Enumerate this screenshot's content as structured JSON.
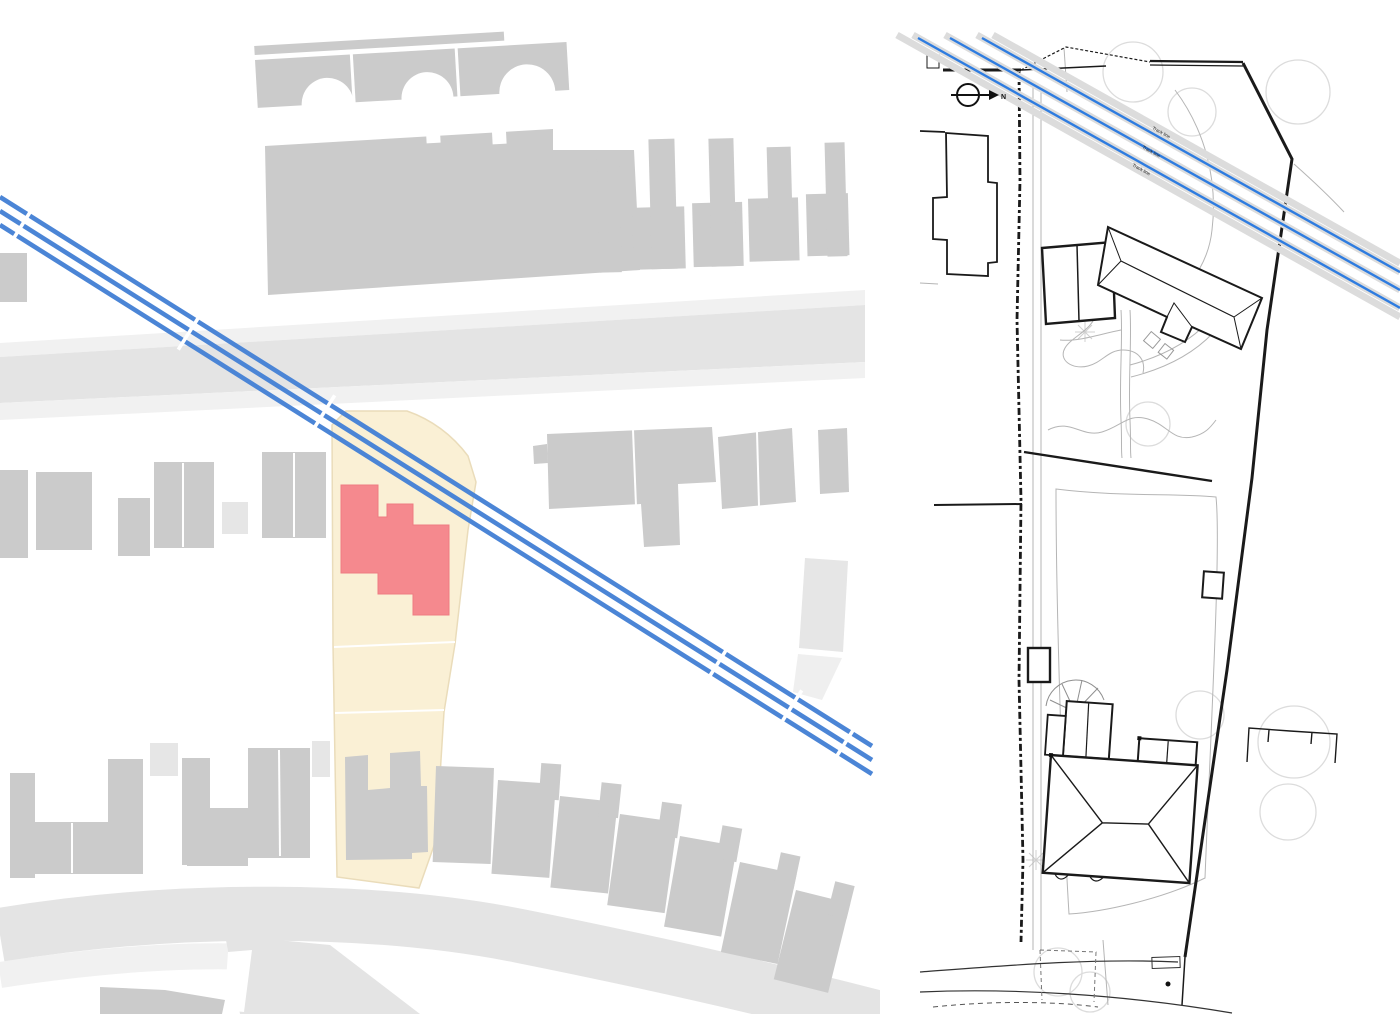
{
  "colors": {
    "building_gray": "#cbcbcb",
    "building_light_gray": "#e6e6e6",
    "building_lighter_gray": "#efefef",
    "road_gray": "#e4e4e4",
    "road_light": "#f1f1f1",
    "site_highlight": "#faf0d5",
    "site_highlight_border": "#eadcba",
    "proposed_building_red": "#f5898e",
    "proposed_building_border": "#ee7c82",
    "map_line_blue": "#4b85d6",
    "plan_line_blue": "#2e7ce0",
    "rail_shadow": "#dcdcdc",
    "plan_black": "#1a1a1a",
    "plan_gray": "#b5b5b5",
    "plan_faint": "#dcdcdc"
  },
  "right_panel": {
    "north_label": "N",
    "track_line_labels": [
      "Track line",
      "Track line",
      "Track line"
    ]
  },
  "icons": {
    "north_arrow": "circle-with-right-arrow"
  }
}
